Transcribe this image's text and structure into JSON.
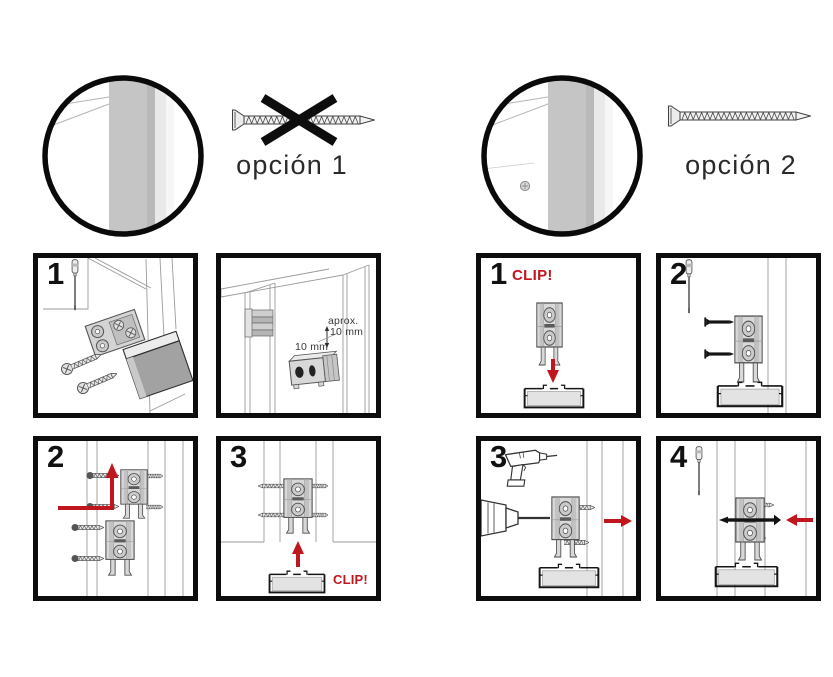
{
  "colors": {
    "accent_red": "#c0161d",
    "panel_border": "#0d0d0d",
    "wood_gray": "#c5c5c5"
  },
  "options": {
    "option1": {
      "label": "opción 1"
    },
    "option2": {
      "label": "opción 2"
    }
  },
  "left_option": {
    "step1": {
      "number": "1"
    },
    "detail": {
      "approx_label": "aprox.",
      "approx_value": "10 mm",
      "depth_label": "10 mm"
    },
    "step2": {
      "number": "2"
    },
    "step3": {
      "number": "3",
      "clip_label": "CLIP!"
    }
  },
  "right_option": {
    "step1": {
      "number": "1",
      "clip_label": "CLIP!"
    },
    "step2": {
      "number": "2"
    },
    "step3": {
      "number": "3"
    },
    "step4": {
      "number": "4"
    }
  }
}
